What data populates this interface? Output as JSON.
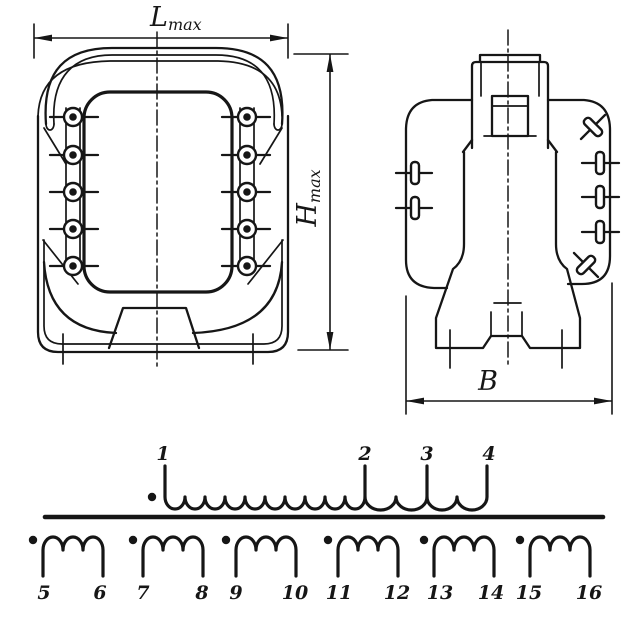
{
  "drawing": {
    "title": "Transformer outline drawing (front and side views) with winding schematic",
    "dimensions": {
      "length": {
        "symbol": "L",
        "subscript": "max"
      },
      "height": {
        "symbol": "H",
        "subscript": "max"
      },
      "width": {
        "symbol": "B"
      }
    },
    "schematic": {
      "primary": {
        "terminals": [
          "1",
          "2",
          "3",
          "4"
        ]
      },
      "secondaries": [
        {
          "start": "5",
          "end": "6"
        },
        {
          "start": "7",
          "end": "8"
        },
        {
          "start": "9",
          "end": "10"
        },
        {
          "start": "11",
          "end": "12"
        },
        {
          "start": "13",
          "end": "14"
        },
        {
          "start": "15",
          "end": "16"
        }
      ]
    },
    "colors": {
      "ink": "#161616",
      "paper": "#ffffff"
    }
  }
}
